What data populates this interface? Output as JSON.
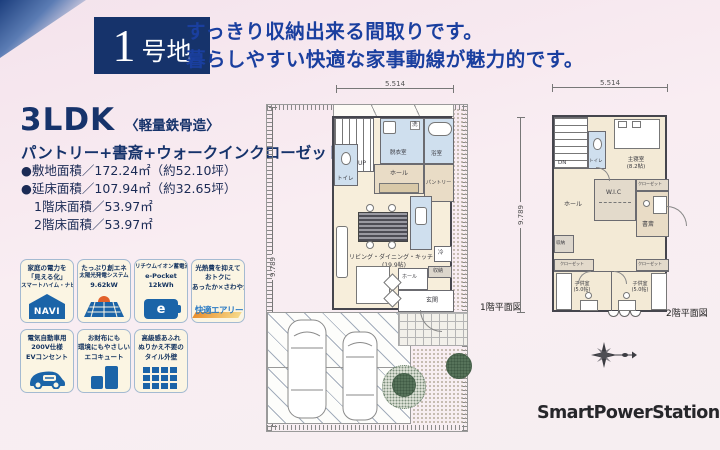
{
  "header": {
    "lot_number": "1",
    "lot_suffix": "号地",
    "headline1": "すっきり収納出来る間取りです。",
    "headline2": "暮らしやすい快適な家事動線が魅力的です。"
  },
  "summary": {
    "type": "3LDK",
    "structure": "〈軽量鉄骨造〉",
    "features": "パントリー+書斎+ウォークインクローゼット",
    "site_area": "●敷地面積／172.24㎡（約52.10坪）",
    "total_area": "●延床面積／107.94㎡（約32.65坪）",
    "floor1_area": "1階床面積／53.97㎡",
    "floor2_area": "2階床面積／53.97㎡"
  },
  "badges": [
    {
      "line1": "家庭の電力を",
      "line2": "「見える化」",
      "line3": "スマートハイム・ナビ",
      "icon": "navi-house-icon",
      "icon_label": "NAVI"
    },
    {
      "line1": "たっぷり創エネ",
      "line2": "太陽光発電システム",
      "line3": "9.62kW",
      "icon": "solar-panel-icon",
      "icon_label": ""
    },
    {
      "line1": "リチウムイオン蓄電池",
      "line2": "e-Pocket",
      "line3": "12kWh",
      "icon": "battery-icon",
      "icon_label": "e"
    },
    {
      "line1": "光熱費を抑えて",
      "line2": "おトクに",
      "line3": "あったか×さわやか",
      "icon": "kaiteki-airy-logo",
      "icon_label": "快適エアリー"
    },
    {
      "line1": "電気自動車用",
      "line2": "200V仕様",
      "line3": "EVコンセント",
      "icon": "ev-car-icon",
      "icon_label": ""
    },
    {
      "line1": "お財布にも",
      "line2": "環境にもやさしい",
      "line3": "エコキュート",
      "icon": "ecocute-icon",
      "icon_label": ""
    },
    {
      "line1": "高級感あふれ",
      "line2": "ぬりかえ不要の",
      "line3": "タイル外壁",
      "icon": "tile-wall-icon",
      "icon_label": ""
    }
  ],
  "plan1": {
    "caption": "1階平面図",
    "dim_width": "5.514",
    "dim_height": "9.789",
    "rooms": {
      "stairs": "UP",
      "toilet": "トイレ",
      "wash": "洗",
      "dressing": "脱衣室",
      "bath": "浴室",
      "hall_upper": "ホール",
      "pantry": "パントリー",
      "ldk": "リビング・ダイニング・キッチン",
      "ldk_size": "(19.9帖)",
      "fridge": "冷",
      "storage": "収納",
      "hall_lower": "ホール",
      "entrance": "玄関"
    }
  },
  "plan2": {
    "caption": "2階平面図",
    "dim_width": "5.514",
    "dim_height": "9.789",
    "rooms": {
      "stairs": "DN",
      "toilet": "トイレ",
      "master": "主寝室",
      "master_size": "(8.2帖)",
      "hall": "ホール",
      "wic": "W.I.C",
      "closet_a": "クローゼット",
      "study": "書斎",
      "storage": "収納",
      "closet_b": "クローゼット",
      "closet_c": "クローゼット",
      "kids1": "子供室",
      "kids1_size": "(5.0帖)",
      "kids2": "子供室",
      "kids2_size": "(5.0帖)"
    }
  },
  "brand": {
    "name": "SmartPowerStation",
    "suffix": "FX"
  }
}
